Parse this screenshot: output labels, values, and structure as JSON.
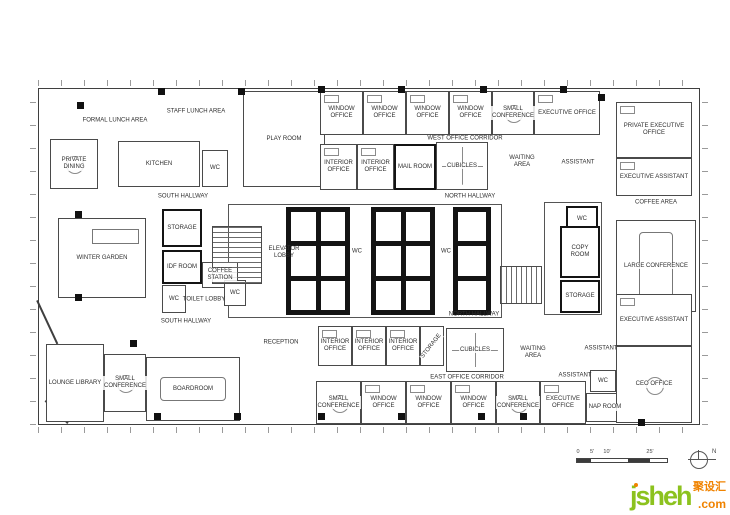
{
  "plan": {
    "outline": {
      "x": 38,
      "y": 88,
      "w": 662,
      "h": 337
    },
    "core_outline": {
      "x": 228,
      "y": 204,
      "w": 274,
      "h": 114
    },
    "right_core_outline": {
      "x": 544,
      "y": 202,
      "w": 58,
      "h": 113
    },
    "diagonals": [
      {
        "x": 38,
        "y": 300,
        "len": 48,
        "deg": 65
      },
      {
        "x": 46,
        "y": 400,
        "len": 32,
        "deg": 45
      }
    ],
    "rooms": [
      {
        "id": "private-dining",
        "label": "PRIVATE DINING",
        "x": 50,
        "y": 139,
        "w": 48,
        "h": 50,
        "cls": "conf"
      },
      {
        "id": "kitchen",
        "label": "KITCHEN",
        "x": 118,
        "y": 141,
        "w": 82,
        "h": 46,
        "cls": ""
      },
      {
        "id": "wc-kitchen",
        "label": "WC",
        "x": 202,
        "y": 150,
        "w": 26,
        "h": 37,
        "cls": ""
      },
      {
        "id": "play-room",
        "label": "PLAY ROOM",
        "x": 243,
        "y": 91,
        "w": 82,
        "h": 96,
        "cls": ""
      },
      {
        "id": "window-office-t1",
        "label": "WINDOW OFFICE",
        "x": 320,
        "y": 91,
        "w": 43,
        "h": 44,
        "cls": "office"
      },
      {
        "id": "window-office-t2",
        "label": "WINDOW OFFICE",
        "x": 363,
        "y": 91,
        "w": 43,
        "h": 44,
        "cls": "office"
      },
      {
        "id": "window-office-t3",
        "label": "WINDOW OFFICE",
        "x": 406,
        "y": 91,
        "w": 43,
        "h": 44,
        "cls": "office"
      },
      {
        "id": "window-office-t4",
        "label": "WINDOW OFFICE",
        "x": 449,
        "y": 91,
        "w": 43,
        "h": 44,
        "cls": "office"
      },
      {
        "id": "small-conference-t",
        "label": "SMALL CONFERENCE",
        "x": 492,
        "y": 91,
        "w": 42,
        "h": 44,
        "cls": "conf"
      },
      {
        "id": "executive-office-t",
        "label": "EXECUTIVE OFFICE",
        "x": 534,
        "y": 91,
        "w": 66,
        "h": 44,
        "cls": "office"
      },
      {
        "id": "interior-office-t1",
        "label": "INTERIOR OFFICE",
        "x": 320,
        "y": 144,
        "w": 37,
        "h": 46,
        "cls": "office"
      },
      {
        "id": "interior-office-t2",
        "label": "INTERIOR OFFICE",
        "x": 357,
        "y": 144,
        "w": 37,
        "h": 46,
        "cls": "office"
      },
      {
        "id": "mail-room",
        "label": "MAIL ROOM",
        "x": 394,
        "y": 144,
        "w": 42,
        "h": 46,
        "cls": "thick"
      },
      {
        "id": "cubicles-t",
        "label": "CUBICLES",
        "x": 436,
        "y": 142,
        "w": 52,
        "h": 48,
        "cls": "cubicles"
      },
      {
        "id": "private-executive-office",
        "label": "PRIVATE EXECUTIVE OFFICE",
        "x": 616,
        "y": 102,
        "w": 76,
        "h": 56,
        "cls": "office"
      },
      {
        "id": "executive-assistant-t",
        "label": "EXECUTIVE ASSISTANT",
        "x": 616,
        "y": 158,
        "w": 76,
        "h": 38,
        "cls": "office"
      },
      {
        "id": "large-conference",
        "label": "LARGE CONFERENCE",
        "x": 616,
        "y": 220,
        "w": 80,
        "h": 92,
        "cls": "tallboard"
      },
      {
        "id": "winter-garden",
        "label": "WINTER GARDEN",
        "x": 58,
        "y": 218,
        "w": 88,
        "h": 80,
        "cls": "wgarden"
      },
      {
        "id": "storage-ml",
        "label": "STORAGE",
        "x": 162,
        "y": 209,
        "w": 40,
        "h": 38,
        "cls": "thick"
      },
      {
        "id": "idf-room",
        "label": "IDF ROOM",
        "x": 162,
        "y": 250,
        "w": 40,
        "h": 34,
        "cls": "thick"
      },
      {
        "id": "coffee-station",
        "label": "COFFEE STATION",
        "x": 202,
        "y": 262,
        "w": 36,
        "h": 26,
        "cls": ""
      },
      {
        "id": "wc-ml1",
        "label": "WC",
        "x": 162,
        "y": 285,
        "w": 24,
        "h": 28,
        "cls": ""
      },
      {
        "id": "wc-ml2",
        "label": "WC",
        "x": 224,
        "y": 280,
        "w": 22,
        "h": 26,
        "cls": ""
      },
      {
        "id": "wc-mr",
        "label": "WC",
        "x": 566,
        "y": 206,
        "w": 32,
        "h": 26,
        "cls": "thick"
      },
      {
        "id": "copy-room",
        "label": "COPY ROOM",
        "x": 560,
        "y": 226,
        "w": 40,
        "h": 52,
        "cls": "thick"
      },
      {
        "id": "storage-mr",
        "label": "STORAGE",
        "x": 560,
        "y": 280,
        "w": 40,
        "h": 33,
        "cls": "thick"
      },
      {
        "id": "lounge-library",
        "label": "LOUNGE LIBRARY",
        "x": 46,
        "y": 344,
        "w": 58,
        "h": 78,
        "cls": ""
      },
      {
        "id": "small-conference-sw",
        "label": "SMALL CONFERENCE",
        "x": 104,
        "y": 354,
        "w": 42,
        "h": 58,
        "cls": "conf"
      },
      {
        "id": "boardroom",
        "label": "BOARDROOM",
        "x": 146,
        "y": 357,
        "w": 94,
        "h": 64,
        "cls": "board"
      },
      {
        "id": "interior-office-s1",
        "label": "INTERIOR OFFICE",
        "x": 318,
        "y": 326,
        "w": 34,
        "h": 40,
        "cls": "office"
      },
      {
        "id": "interior-office-s2",
        "label": "INTERIOR OFFICE",
        "x": 352,
        "y": 326,
        "w": 34,
        "h": 40,
        "cls": "office"
      },
      {
        "id": "interior-office-s3",
        "label": "INTERIOR OFFICE",
        "x": 386,
        "y": 326,
        "w": 34,
        "h": 40,
        "cls": "office"
      },
      {
        "id": "storage-s",
        "label": "STORAGE",
        "x": 420,
        "y": 326,
        "w": 24,
        "h": 40,
        "cls": "vert"
      },
      {
        "id": "cubicles-s",
        "label": "CUBICLES",
        "x": 446,
        "y": 328,
        "w": 58,
        "h": 44,
        "cls": "cubicles"
      },
      {
        "id": "wc-se",
        "label": "WC",
        "x": 590,
        "y": 370,
        "w": 26,
        "h": 22,
        "cls": ""
      },
      {
        "id": "nap-room",
        "label": "NAP ROOM",
        "x": 586,
        "y": 393,
        "w": 38,
        "h": 29,
        "cls": ""
      },
      {
        "id": "executive-assistant-s",
        "label": "EXECUTIVE ASSISTANT",
        "x": 616,
        "y": 294,
        "w": 76,
        "h": 52,
        "cls": "office"
      },
      {
        "id": "ceo-office",
        "label": "CEO OFFICE",
        "x": 616,
        "y": 346,
        "w": 76,
        "h": 77,
        "cls": "conf"
      },
      {
        "id": "small-conference-s1",
        "label": "SMALL CONFERENCE",
        "x": 316,
        "y": 381,
        "w": 45,
        "h": 43,
        "cls": "conf"
      },
      {
        "id": "window-office-s1",
        "label": "WINDOW OFFICE",
        "x": 361,
        "y": 381,
        "w": 45,
        "h": 43,
        "cls": "office"
      },
      {
        "id": "window-office-s2",
        "label": "WINDOW OFFICE",
        "x": 406,
        "y": 381,
        "w": 45,
        "h": 43,
        "cls": "office"
      },
      {
        "id": "window-office-s3",
        "label": "WINDOW OFFICE",
        "x": 451,
        "y": 381,
        "w": 45,
        "h": 43,
        "cls": "office"
      },
      {
        "id": "small-conference-s2",
        "label": "SMALL CONFERENCE",
        "x": 496,
        "y": 381,
        "w": 44,
        "h": 43,
        "cls": "conf"
      },
      {
        "id": "executive-office-s",
        "label": "EXECUTIVE OFFICE",
        "x": 540,
        "y": 381,
        "w": 46,
        "h": 43,
        "cls": "office"
      }
    ],
    "area_labels": [
      {
        "id": "formal-lunch-area",
        "label": "FORMAL LUNCH AREA",
        "x": 115,
        "y": 121
      },
      {
        "id": "staff-lunch-area",
        "label": "STAFF LUNCH AREA",
        "x": 196,
        "y": 112
      },
      {
        "id": "south-hallway-1",
        "label": "SOUTH HALLWAY",
        "x": 183,
        "y": 197
      },
      {
        "id": "south-hallway-2",
        "label": "SOUTH HALLWAY",
        "x": 186,
        "y": 322
      },
      {
        "id": "north-hallway-1",
        "label": "NORTH HALLWAY",
        "x": 470,
        "y": 197
      },
      {
        "id": "north-hallway-2",
        "label": "NORTH HALLWAY",
        "x": 474,
        "y": 315
      },
      {
        "id": "west-office-corridor",
        "label": "WEST OFFICE CORRIDOR",
        "x": 465,
        "y": 139
      },
      {
        "id": "east-office-corridor",
        "label": "EAST OFFICE CORRIDOR",
        "x": 467,
        "y": 378
      },
      {
        "id": "elevator-lobby",
        "label": "ELEVATOR LOBBY",
        "x": 284,
        "y": 253,
        "w": 34
      },
      {
        "id": "toilet-lobby",
        "label": "TOILET LOBBY",
        "x": 204,
        "y": 300
      },
      {
        "id": "coffee-area",
        "label": "COFFEE AREA",
        "x": 656,
        "y": 203
      },
      {
        "id": "reception",
        "label": "RECEPTION",
        "x": 281,
        "y": 343
      },
      {
        "id": "waiting-area-t",
        "label": "WAITING AREA",
        "x": 522,
        "y": 162,
        "w": 28
      },
      {
        "id": "waiting-area-s",
        "label": "WAITING AREA",
        "x": 533,
        "y": 353,
        "w": 28
      },
      {
        "id": "assistant-t",
        "label": "ASSISTANT",
        "x": 578,
        "y": 163
      },
      {
        "id": "assistant-s1",
        "label": "ASSISTANT",
        "x": 601,
        "y": 349
      },
      {
        "id": "assistant-s2",
        "label": "ASSISTANT",
        "x": 575,
        "y": 376
      },
      {
        "id": "wc-core-1",
        "label": "WC",
        "x": 357,
        "y": 252
      },
      {
        "id": "wc-core-2",
        "label": "WC",
        "x": 446,
        "y": 252
      }
    ],
    "cores": [
      {
        "id": "elevator-bank-a",
        "x": 286,
        "y": 207,
        "w": 64,
        "h": 108,
        "cols": 2,
        "rows": 3
      },
      {
        "id": "elevator-bank-b",
        "x": 371,
        "y": 207,
        "w": 64,
        "h": 108,
        "cols": 2,
        "rows": 3
      },
      {
        "id": "elevator-bank-c",
        "x": 453,
        "y": 207,
        "w": 38,
        "h": 108,
        "cols": 1,
        "rows": 3
      }
    ],
    "stairs": [
      {
        "id": "stair-west",
        "x": 212,
        "y": 226,
        "w": 50,
        "h": 58,
        "dir": "v"
      },
      {
        "id": "stair-east",
        "x": 500,
        "y": 266,
        "w": 42,
        "h": 38,
        "dir": "h"
      }
    ],
    "columns": [
      [
        80,
        105
      ],
      [
        161,
        91
      ],
      [
        241,
        91
      ],
      [
        321,
        89
      ],
      [
        401,
        89
      ],
      [
        483,
        89
      ],
      [
        563,
        89
      ],
      [
        601,
        97
      ],
      [
        78,
        214
      ],
      [
        78,
        297
      ],
      [
        133,
        343
      ],
      [
        157,
        416
      ],
      [
        237,
        416
      ],
      [
        321,
        416
      ],
      [
        401,
        416
      ],
      [
        481,
        416
      ],
      [
        523,
        416
      ],
      [
        641,
        422
      ]
    ]
  },
  "scale_bar": {
    "labels": [
      "0",
      "5'",
      "10'",
      "25'"
    ]
  },
  "north": {
    "letter": "N"
  },
  "watermark": {
    "name": "jsheh",
    "tld": ".com",
    "cn": "聚设汇",
    "green": "#8cc21e",
    "orange": "#f08300"
  }
}
